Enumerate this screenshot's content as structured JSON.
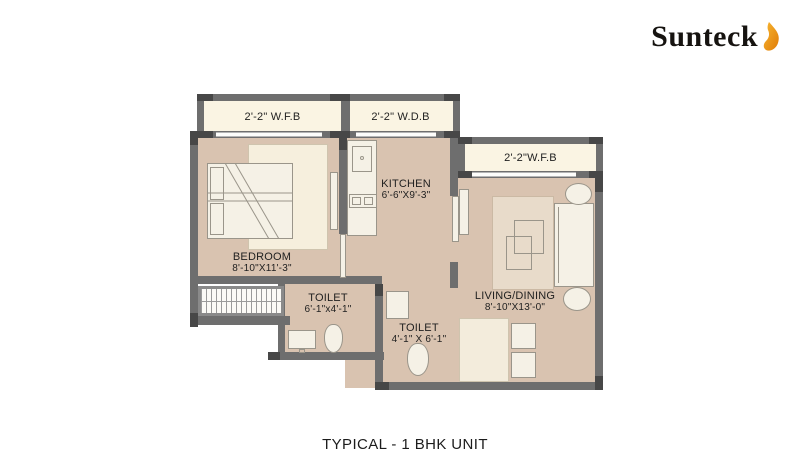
{
  "brand": {
    "name": "Sunteck",
    "flame_color": "#E8850C"
  },
  "title": "TYPICAL - 1 BHK UNIT",
  "colors": {
    "wall": "#6e6e6e",
    "wall_joint": "#474747",
    "floor": "#d9c3b0",
    "closet_fill": "#faf4e3",
    "rug": "#e8dbca",
    "background": "#ffffff"
  },
  "rooms": {
    "wfb_top": {
      "label": "2'-2\" W.F.B"
    },
    "wdb_top": {
      "label": "2'-2\" W.D.B"
    },
    "wfb_right": {
      "label": "2'-2\"W.F.B"
    },
    "kitchen": {
      "name": "KITCHEN",
      "dims": "6'-6\"X9'-3\""
    },
    "bedroom": {
      "name": "BEDROOM",
      "dims": "8'-10\"X11'-3\""
    },
    "toilet_1": {
      "name": "TOILET",
      "dims": "6'-1\"x4'-1\""
    },
    "toilet_2": {
      "name": "TOILET",
      "dims": "4'-1\" X 6'-1\""
    },
    "living_dining": {
      "name": "LIVING/DINING",
      "dims": "8'-10\"X13'-0\""
    }
  }
}
